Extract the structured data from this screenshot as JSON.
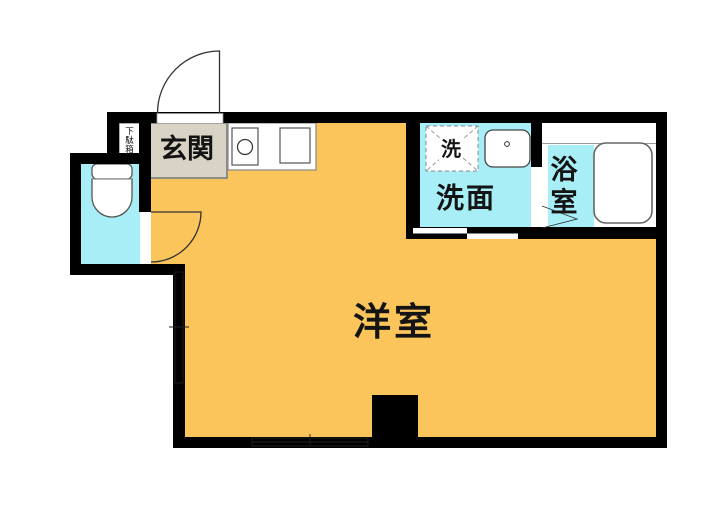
{
  "title": "日本の間取り図 (Japanese apartment floor plan)",
  "colors": {
    "wall": "#000000",
    "background": "#ffffff",
    "main_floor": "#FBC55C",
    "wet_floor": "#A8EEF6",
    "genkan_fill": "#D9D3C5",
    "genkan_border": "#8C8C80"
  },
  "rooms": {
    "main": {
      "label": "洋室"
    },
    "genkan": {
      "label": "玄関"
    },
    "getabako": {
      "chars": [
        "下",
        "駄",
        "箱"
      ]
    },
    "washroom": {
      "label": "洗面"
    },
    "washer": {
      "label": "洗"
    },
    "bathroom": {
      "chars": [
        "浴",
        "室"
      ]
    }
  }
}
